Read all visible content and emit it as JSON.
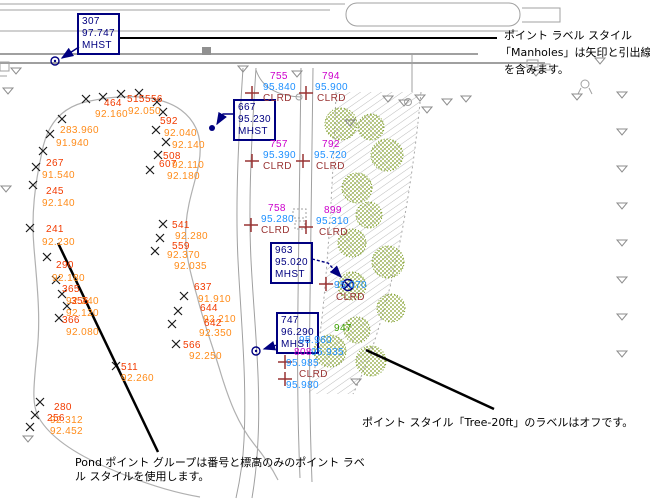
{
  "notes": {
    "manholes_l1": "ポイント ラベル スタイル",
    "manholes_l2": "「Manholes」は矢印と引出線",
    "manholes_l3": "を含みます。",
    "tree": "ポイント スタイル「Tree-20ft」のラベルはオフです。",
    "pond_l1": "Pond ポイント グループは番号と標高のみのポイント ラベ",
    "pond_l2": "ル スタイルを使用します。"
  },
  "manholes": [
    {
      "num": "307",
      "elev": "97.747",
      "desc": "MHST"
    },
    {
      "num": "667",
      "elev": "95.230",
      "desc": "MHST"
    },
    {
      "num": "963",
      "elev": "95.020",
      "desc": "MHST"
    },
    {
      "num": "747",
      "elev": "96.290",
      "desc": "MHST"
    }
  ],
  "curbs": [
    {
      "num": "755",
      "elev": "95.840",
      "desc": "CLRD"
    },
    {
      "num": "794",
      "elev": "95.900",
      "desc": "CLRD"
    },
    {
      "num": "757",
      "elev": "95.390",
      "desc": "CLRD"
    },
    {
      "num": "792",
      "elev": "95.720",
      "desc": "CLRD"
    },
    {
      "num": "758",
      "elev": "95.280",
      "desc": "CLRD"
    },
    {
      "num": "899",
      "elev": "95.310",
      "desc": "CLRD"
    }
  ],
  "mh_point": {
    "elev": "95.070",
    "desc": "CLRD"
  },
  "cluster": {
    "green": "947",
    "c1": "95.960",
    "m1": "808",
    "c2": "95.935",
    "c3": "95.985",
    "d1": "CLRD",
    "c4": "95.980"
  },
  "pond": [
    "515",
    "556",
    "464",
    "92.160",
    "92.050",
    "283.960",
    "91.940",
    "267",
    "91.540",
    "245",
    "92.140",
    "241",
    "92.230",
    "290",
    "92.180",
    "365",
    "92.240",
    "356",
    "92.120",
    "366",
    "92.080",
    "280",
    "92.312",
    "256",
    "92.452",
    "592",
    "92.040",
    "92.140",
    "508",
    "607",
    "92.110",
    "92.180",
    "541",
    "92.280",
    "559",
    "92.370",
    "92.035",
    "637",
    "91.910",
    "644",
    "92.210",
    "642",
    "92.350",
    "566",
    "92.250",
    "511",
    "92.260"
  ],
  "colors": {
    "number": "#f23b00",
    "elevation": "#ff8c1a",
    "magenta": "#cc00cc",
    "cyan": "#1e90ff",
    "description": "#993333",
    "navy": "#000080",
    "tree": "#84a12e",
    "linework": "#a6a6a6",
    "green": "#3aa000",
    "leader": "#000000"
  }
}
